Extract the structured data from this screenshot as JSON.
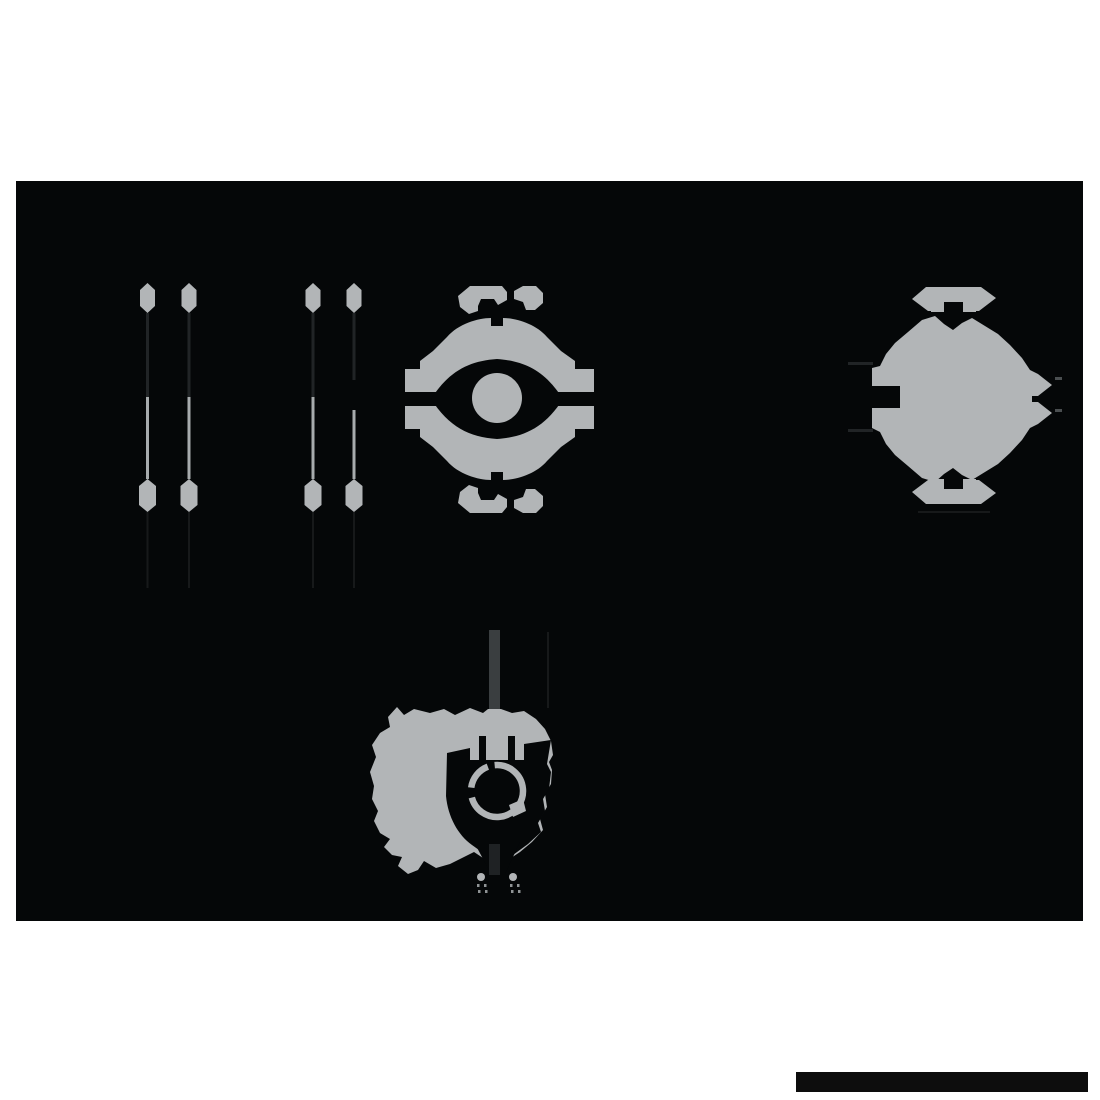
{
  "meta": {
    "description": "Dark multi-view silhouette sheet: two pairs of vertical rail pins, a front view and a side view of a spherical eye-core device, a 3/4 perspective view on a pole, and a black footer bar",
    "canvas": {
      "x": 16,
      "y": 181,
      "width": 1067,
      "height": 740
    },
    "page": {
      "width": 1100,
      "height": 1100
    }
  },
  "palette": {
    "page_background": "#ffffff",
    "canvas_background": "#050708",
    "part_gray": "#b2b5b7",
    "rail_line_light": "#a7abad",
    "rail_line_dark": "#212426",
    "faint_line": "#17191a",
    "pole_gray": "#3a3e40",
    "pole_dark": "#1f2224",
    "small_dash": "#4a4e50",
    "tiny_dot_gray": "#8f9395",
    "footer_bar": "#0d0d0d"
  },
  "shapes": [
    {
      "name": "drawing-canvas-background",
      "type": "rect",
      "attrs": {
        "x": 16,
        "y": 181,
        "width": 1067,
        "height": 740,
        "fill": "#050708"
      }
    },
    {
      "name": "rail-1-top-cap",
      "type": "polygon",
      "attrs": {
        "points": "147.5,283 155,290 155,306 147.5,313 140,306 140,290",
        "fill": "#b2b5b7"
      }
    },
    {
      "name": "rail-1-upper-shaft",
      "type": "rect",
      "attrs": {
        "x": 146,
        "y": 313,
        "width": 3,
        "height": 84,
        "fill": "#212426"
      }
    },
    {
      "name": "rail-1-lower-shaft",
      "type": "rect",
      "attrs": {
        "x": 146,
        "y": 397,
        "width": 3,
        "height": 82,
        "fill": "#a7abad"
      }
    },
    {
      "name": "rail-1-bottom-cap",
      "type": "polygon",
      "attrs": {
        "points": "147.5,479 156,486 156,505 147.5,512 139,505 139,486",
        "fill": "#b2b5b7"
      }
    },
    {
      "name": "rail-1-tail-line",
      "type": "rect",
      "attrs": {
        "x": 146.5,
        "y": 512,
        "width": 2,
        "height": 76,
        "fill": "#17191a"
      }
    },
    {
      "name": "rail-2-top-cap",
      "type": "polygon",
      "attrs": {
        "points": "189,283 196.5,290 196.5,306 189,313 181.5,306 181.5,290",
        "fill": "#b2b5b7"
      }
    },
    {
      "name": "rail-2-upper-shaft",
      "type": "rect",
      "attrs": {
        "x": 187.5,
        "y": 313,
        "width": 3,
        "height": 84,
        "fill": "#212426"
      }
    },
    {
      "name": "rail-2-lower-shaft",
      "type": "rect",
      "attrs": {
        "x": 187.5,
        "y": 397,
        "width": 3,
        "height": 82,
        "fill": "#a7abad"
      }
    },
    {
      "name": "rail-2-bottom-cap",
      "type": "polygon",
      "attrs": {
        "points": "189,479 197.5,486 197.5,505 189,512 180.5,505 180.5,486",
        "fill": "#b2b5b7"
      }
    },
    {
      "name": "rail-2-tail-line",
      "type": "rect",
      "attrs": {
        "x": 188,
        "y": 512,
        "width": 2,
        "height": 76,
        "fill": "#17191a"
      }
    },
    {
      "name": "rail-3-top-cap",
      "type": "polygon",
      "attrs": {
        "points": "313,283 320.5,290 320.5,306 313,313 305.5,306 305.5,290",
        "fill": "#b2b5b7"
      }
    },
    {
      "name": "rail-3-upper-shaft",
      "type": "rect",
      "attrs": {
        "x": 311.5,
        "y": 313,
        "width": 3,
        "height": 84,
        "fill": "#212426"
      }
    },
    {
      "name": "rail-3-lower-shaft",
      "type": "rect",
      "attrs": {
        "x": 311.5,
        "y": 397,
        "width": 3,
        "height": 82,
        "fill": "#a7abad"
      }
    },
    {
      "name": "rail-3-bottom-cap",
      "type": "polygon",
      "attrs": {
        "points": "313,479 321.5,486 321.5,505 313,512 304.5,505 304.5,486",
        "fill": "#b2b5b7"
      }
    },
    {
      "name": "rail-3-tail-line",
      "type": "rect",
      "attrs": {
        "x": 312,
        "y": 512,
        "width": 2,
        "height": 76,
        "fill": "#17191a"
      }
    },
    {
      "name": "rail-4-top-cap",
      "type": "polygon",
      "attrs": {
        "points": "354,283 361.5,290 361.5,306 354,313 346.5,306 346.5,290",
        "fill": "#b2b5b7"
      }
    },
    {
      "name": "rail-4-upper-shaft",
      "type": "rect",
      "attrs": {
        "x": 352.5,
        "y": 313,
        "width": 3,
        "height": 67,
        "fill": "#212426"
      }
    },
    {
      "name": "rail-4-lower-shaft",
      "type": "rect",
      "attrs": {
        "x": 352.5,
        "y": 410,
        "width": 3,
        "height": 69,
        "fill": "#a7abad"
      }
    },
    {
      "name": "rail-4-bottom-cap",
      "type": "polygon",
      "attrs": {
        "points": "354,479 362.5,486 362.5,505 354,512 345.5,505 345.5,486",
        "fill": "#b2b5b7"
      }
    },
    {
      "name": "rail-4-tail-line",
      "type": "rect",
      "attrs": {
        "x": 353,
        "y": 512,
        "width": 2,
        "height": 76,
        "fill": "#17191a"
      }
    },
    {
      "name": "front-view-body",
      "type": "path",
      "attrs": {
        "d": "M447 337 C458 324 478 318 491 318 L491 326 L503 326 L503 318 C516 318 536 324 547 337 L561 351 L575 361 L575 437 L561 447 L547 461 C536 474 516 480 503 480 L503 472 L491 472 L491 480 C478 480 458 474 447 461 L433 447 L420 437 L420 361 L433 351 Z",
        "fill": "#b2b5b7"
      }
    },
    {
      "name": "front-view-left-wing-upper",
      "type": "rect",
      "attrs": {
        "x": 405,
        "y": 369,
        "width": 38,
        "height": 23,
        "fill": "#b2b5b7"
      }
    },
    {
      "name": "front-view-left-wing-lower",
      "type": "rect",
      "attrs": {
        "x": 405,
        "y": 406,
        "width": 38,
        "height": 23,
        "fill": "#b2b5b7"
      }
    },
    {
      "name": "front-view-right-wing-upper",
      "type": "rect",
      "attrs": {
        "x": 556,
        "y": 369,
        "width": 38,
        "height": 23,
        "fill": "#b2b5b7"
      }
    },
    {
      "name": "front-view-right-wing-lower",
      "type": "rect",
      "attrs": {
        "x": 556,
        "y": 406,
        "width": 38,
        "height": 23,
        "fill": "#b2b5b7"
      }
    },
    {
      "name": "front-view-left-slot",
      "type": "rect",
      "attrs": {
        "x": 398,
        "y": 392,
        "width": 50,
        "height": 14,
        "fill": "#050708"
      }
    },
    {
      "name": "front-view-right-slot",
      "type": "rect",
      "attrs": {
        "x": 551,
        "y": 392,
        "width": 50,
        "height": 14,
        "fill": "#050708"
      }
    },
    {
      "name": "front-view-eye-socket",
      "type": "path",
      "attrs": {
        "d": "M431 399 C449 371 469 361 497 359 C525 361 545 371 563 399 C545 427 525 437 497 439 C469 437 449 427 431 399 Z",
        "fill": "#050708"
      }
    },
    {
      "name": "front-view-eye",
      "type": "circle",
      "attrs": {
        "cx": 497,
        "cy": 398,
        "r": 25,
        "fill": "#b2b5b7"
      }
    },
    {
      "name": "front-view-top-handle-left",
      "type": "path",
      "attrs": {
        "d": "M458 296 L470 286 L502 286 L507 292 L507 300 L498 305 L494 299 L481 299 L478 306 L478 311 L469 314 L460 307 Z",
        "fill": "#b2b5b7"
      }
    },
    {
      "name": "front-view-top-handle-right",
      "type": "path",
      "attrs": {
        "d": "M514 291 L523 286 L536 286 L543 293 L543 303 L535 310 L526 310 L523 302 L514 299 Z",
        "fill": "#b2b5b7"
      }
    },
    {
      "name": "front-view-bottom-handle-left",
      "type": "path",
      "attrs": {
        "d": "M458 503 L470 513 L502 513 L507 507 L507 499 L498 494 L494 500 L481 500 L478 493 L478 488 L469 485 L460 492 Z",
        "fill": "#b2b5b7"
      }
    },
    {
      "name": "front-view-bottom-handle-right",
      "type": "path",
      "attrs": {
        "d": "M514 508 L523 513 L536 513 L543 506 L543 496 L535 489 L526 489 L523 497 L514 500 Z",
        "fill": "#b2b5b7"
      }
    },
    {
      "name": "side-view-body",
      "type": "path",
      "attrs": {
        "d": "M908 332 L922 320 L935 316 L944 324 L953 330 L962 323 L972 318 L985 326 L998 334 L1010 345 L1022 358 L1030 370 L1038 374 L1052 385 L1038 396 L1032 396 L1032 402 L1038 402 L1052 413 L1038 424 L1030 428 L1022 440 L1010 453 L998 464 L985 472 L972 480 L962 475 L953 468 L944 474 L935 482 L922 478 L908 466 L895 455 L886 444 L880 432 L872 428 L872 408 L900 408 L900 386 L872 386 L872 368 L880 366 L886 354 L895 343 Z",
        "fill": "#b2b5b7"
      }
    },
    {
      "name": "side-view-top-handle",
      "type": "path",
      "attrs": {
        "d": "M912 299 L926 287 L981 287 L996 298 L979 311 L976 311 L976 312 L963 312 L963 302 L944 302 L944 312 L931 312 L931 311 L928 311 Z",
        "fill": "#b2b5b7"
      }
    },
    {
      "name": "side-view-bottom-handle",
      "type": "path",
      "attrs": {
        "d": "M912 492 L928 480 L931 480 L931 479 L944 479 L944 489 L963 489 L963 479 L976 479 L976 480 L979 480 L996 493 L981 504 L926 504 Z",
        "fill": "#b2b5b7"
      }
    },
    {
      "name": "side-view-left-callout-line-upper",
      "type": "rect",
      "attrs": {
        "x": 848,
        "y": 362,
        "width": 25,
        "height": 3,
        "fill": "#212426"
      }
    },
    {
      "name": "side-view-left-callout-line-lower",
      "type": "rect",
      "attrs": {
        "x": 848,
        "y": 429,
        "width": 25,
        "height": 3,
        "fill": "#212426"
      }
    },
    {
      "name": "side-view-right-dash-upper",
      "type": "rect",
      "attrs": {
        "x": 1055,
        "y": 377,
        "width": 7,
        "height": 3,
        "fill": "#4a4e50"
      }
    },
    {
      "name": "side-view-right-dash-lower",
      "type": "rect",
      "attrs": {
        "x": 1055,
        "y": 409,
        "width": 7,
        "height": 3,
        "fill": "#4a4e50"
      }
    },
    {
      "name": "side-view-under-line",
      "type": "rect",
      "attrs": {
        "x": 918,
        "y": 511,
        "width": 72,
        "height": 2,
        "fill": "#17191a"
      }
    },
    {
      "name": "perspective-view-faint-line",
      "type": "rect",
      "attrs": {
        "x": 547,
        "y": 632,
        "width": 2,
        "height": 76,
        "fill": "#17191a"
      }
    },
    {
      "name": "perspective-view-pole-upper",
      "type": "rect",
      "attrs": {
        "x": 489,
        "y": 630,
        "width": 11,
        "height": 82,
        "fill": "#3a3e40"
      }
    },
    {
      "name": "perspective-view-body",
      "type": "path",
      "attrs": {
        "d": "M388 717 L397 707 L404 715 L414 709 L430 713 L444 709 L455 715 L470 708 L483 713 L488 709 L501 709 L512 713 L524 711 L536 719 L545 729 L551 741 L553 755 L549 762 L552 770 L551 784 L545 794 L547 807 L540 819 L543 830 L532 842 L520 852 L508 860 L497 867 L486 860 L474 852 L462 858 L450 864 L436 868 L424 861 L418 870 L408 874 L398 866 L402 857 L392 855 L384 847 L390 839 L380 833 L374 821 L378 811 L372 799 L374 786 L370 772 L376 757 L372 745 L380 733 L390 727 Z",
        "fill": "#b2b5b7"
      }
    },
    {
      "name": "perspective-view-eye-socket",
      "type": "path",
      "attrs": {
        "d": "M447 753 L470 748 L470 760 L524 760 L524 744 L551 740 L547 764 L551 772 L549 789 L543 799 L545 811 L538 823 L541 832 L528 844 L513 855 L500 863 L486 855 L472 845 C458 835 448 817 446 796 Z",
        "fill": "#050708"
      }
    },
    {
      "name": "perspective-view-slot-left",
      "type": "rect",
      "attrs": {
        "x": 479,
        "y": 736,
        "width": 7,
        "height": 25,
        "fill": "#050708"
      }
    },
    {
      "name": "perspective-view-slot-right",
      "type": "rect",
      "attrs": {
        "x": 508,
        "y": 736,
        "width": 7,
        "height": 25,
        "fill": "#050708"
      }
    },
    {
      "name": "perspective-view-eye-ring",
      "type": "circle",
      "attrs": {
        "cx": 497,
        "cy": 791,
        "r": 26,
        "fill": "none",
        "stroke": "#b2b5b7",
        "stroke-width": 6.5,
        "stroke-dasharray": "58 8 52 10 28 7",
        "transform": "rotate(-95 497 791)"
      }
    },
    {
      "name": "perspective-view-ring-nub",
      "type": "path",
      "attrs": {
        "d": "M509 805 L523 799 L526 811 L513 817 Z",
        "fill": "#b2b5b7"
      }
    },
    {
      "name": "perspective-view-dark-wedge",
      "type": "polygon",
      "attrs": {
        "points": "474,842 520,842 505,874 491,874",
        "fill": "#050708"
      }
    },
    {
      "name": "perspective-view-pole-lower",
      "type": "rect",
      "attrs": {
        "x": 489,
        "y": 844,
        "width": 11,
        "height": 31,
        "fill": "#1f2224"
      }
    },
    {
      "name": "perspective-view-dot-left",
      "type": "circle",
      "attrs": {
        "cx": 481,
        "cy": 877,
        "r": 4,
        "fill": "#b2b5b7"
      }
    },
    {
      "name": "perspective-view-dot-right",
      "type": "circle",
      "attrs": {
        "cx": 513,
        "cy": 877,
        "r": 4,
        "fill": "#b2b5b7"
      }
    },
    {
      "name": "perspective-view-tiny-dot-1",
      "type": "rect",
      "attrs": {
        "x": 477,
        "y": 884,
        "width": 2.5,
        "height": 3,
        "fill": "#8f9395"
      }
    },
    {
      "name": "perspective-view-tiny-dot-2",
      "type": "rect",
      "attrs": {
        "x": 484,
        "y": 884,
        "width": 2.5,
        "height": 3,
        "fill": "#8f9395"
      }
    },
    {
      "name": "perspective-view-tiny-dot-3",
      "type": "rect",
      "attrs": {
        "x": 510,
        "y": 884,
        "width": 2.5,
        "height": 3,
        "fill": "#8f9395"
      }
    },
    {
      "name": "perspective-view-tiny-dot-4",
      "type": "rect",
      "attrs": {
        "x": 517,
        "y": 884,
        "width": 2.5,
        "height": 3,
        "fill": "#8f9395"
      }
    },
    {
      "name": "perspective-view-tiny-dot-5",
      "type": "rect",
      "attrs": {
        "x": 478,
        "y": 890,
        "width": 2.5,
        "height": 3,
        "fill": "#8f9395"
      }
    },
    {
      "name": "perspective-view-tiny-dot-6",
      "type": "rect",
      "attrs": {
        "x": 485,
        "y": 890,
        "width": 2.5,
        "height": 3,
        "fill": "#8f9395"
      }
    },
    {
      "name": "perspective-view-tiny-dot-7",
      "type": "rect",
      "attrs": {
        "x": 511,
        "y": 890,
        "width": 2.5,
        "height": 3,
        "fill": "#8f9395"
      }
    },
    {
      "name": "perspective-view-tiny-dot-8",
      "type": "rect",
      "attrs": {
        "x": 518,
        "y": 890,
        "width": 2.5,
        "height": 3,
        "fill": "#8f9395"
      }
    },
    {
      "name": "footer-bar",
      "type": "rect",
      "attrs": {
        "x": 796,
        "y": 1072,
        "width": 292,
        "height": 20,
        "fill": "#0d0d0d"
      }
    }
  ]
}
